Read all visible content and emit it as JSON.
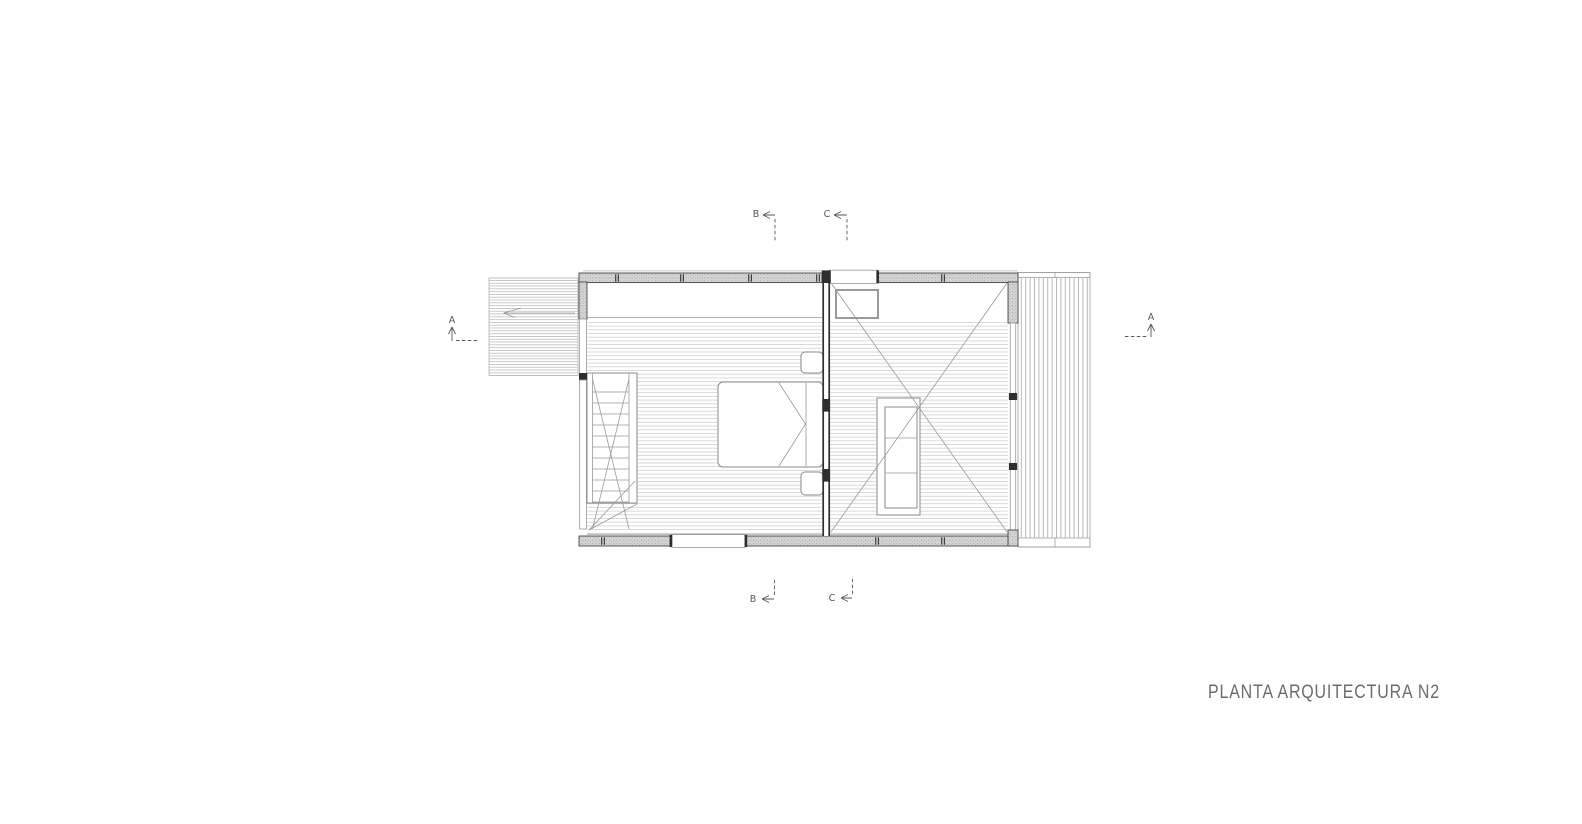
{
  "drawing": {
    "title": "PLANTA ARQUITECTURA N2"
  },
  "markers": {
    "section_a_left": "A",
    "section_a_right": "A",
    "section_b_top": "B",
    "section_b_bottom": "B",
    "section_c_top": "C",
    "section_c_bottom": "C"
  },
  "colors": {
    "background": "#ffffff",
    "wall_outline": "#474747",
    "wall_fill": "#d6d6d6",
    "floor_line": "#c9c9c9",
    "deck_line": "#b3b3b3",
    "furniture_line": "#8a8a8a",
    "detail_line": "#9a9a9a",
    "marker_line": "#575757",
    "dark_wall": "#2f2f2f",
    "title_text": "#6b6b6b"
  }
}
